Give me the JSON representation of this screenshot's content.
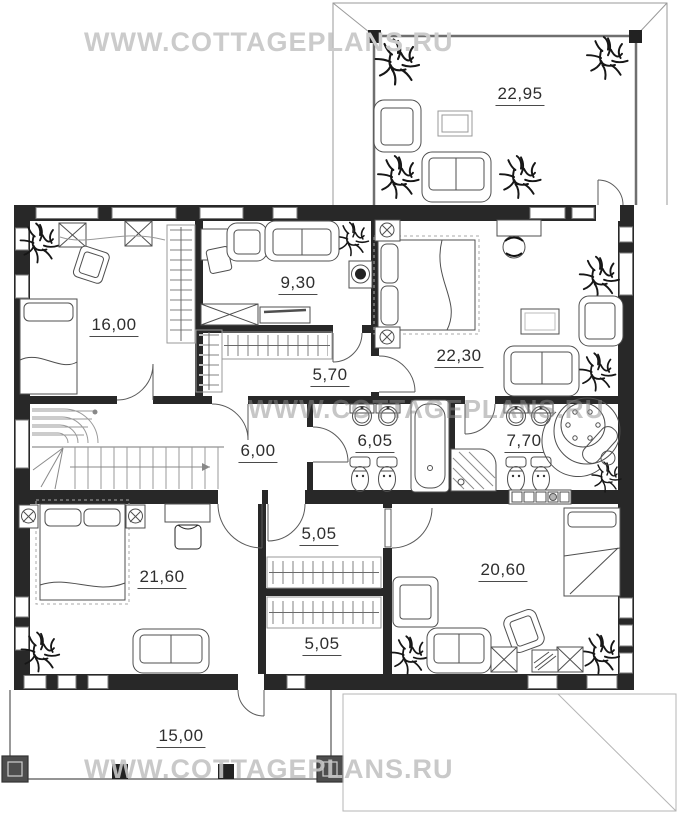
{
  "watermark": {
    "text": "WWW.COTTAGEPLANS.RU"
  },
  "plan": {
    "rooms": [
      {
        "name": "upper-terrace",
        "area": "22,95"
      },
      {
        "name": "bedroom-1",
        "area": "16,00"
      },
      {
        "name": "study",
        "area": "9,30"
      },
      {
        "name": "master-bedroom",
        "area": "22,30"
      },
      {
        "name": "wardrobe-1",
        "area": "5,70"
      },
      {
        "name": "hall",
        "area": "6,00"
      },
      {
        "name": "bathroom-1",
        "area": "6,05"
      },
      {
        "name": "bathroom-2",
        "area": "7,70"
      },
      {
        "name": "bedroom-2",
        "area": "21,60"
      },
      {
        "name": "wardrobe-2",
        "area": "5,05"
      },
      {
        "name": "wardrobe-3",
        "area": "5,05"
      },
      {
        "name": "bedroom-3",
        "area": "20,60"
      },
      {
        "name": "lower-terrace",
        "area": "15,00"
      }
    ]
  },
  "colors": {
    "wall": "#282828",
    "line": "#4f4f4f",
    "light": "#999999",
    "watermark": "#c8c8c8"
  }
}
